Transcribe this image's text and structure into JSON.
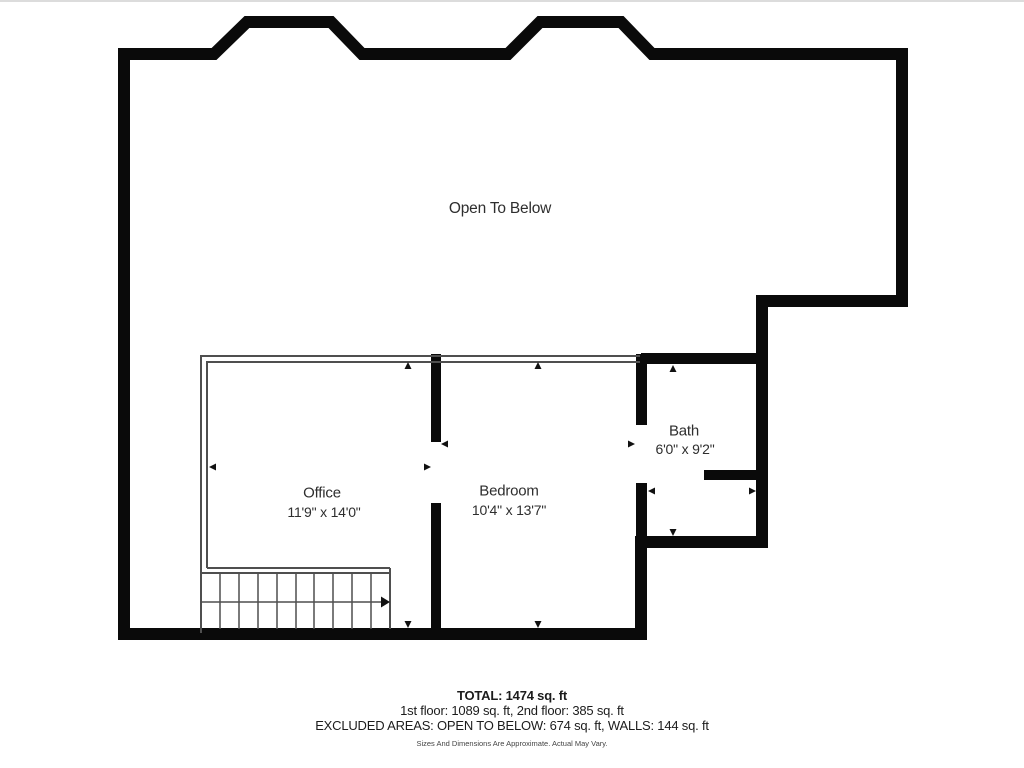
{
  "plan": {
    "open_area_label": "Open To Below",
    "rooms": [
      {
        "name": "Office",
        "dimensions": "11'9\" x 14'0\""
      },
      {
        "name": "Bedroom",
        "dimensions": "10'4\" x 13'7\""
      },
      {
        "name": "Bath",
        "dimensions": "6'0\" x 9'2\""
      }
    ]
  },
  "footer": {
    "total": "TOTAL: 1474 sq. ft",
    "floors": "1st floor: 1089 sq. ft, 2nd floor: 385 sq. ft",
    "excluded": "EXCLUDED AREAS: OPEN TO BELOW: 674 sq. ft, WALLS: 144 sq. ft",
    "disclaimer": "Sizes And Dimensions Are Approximate. Actual May Vary."
  },
  "colors": {
    "wall": "#0a0a0a",
    "thin_wall": "#4f4f4f",
    "label_text": "#2e2e2e",
    "footer_text": "#1c1c1c",
    "disclaimer_text": "#444444",
    "background": "#ffffff",
    "top_border": "#dcdcdc"
  }
}
